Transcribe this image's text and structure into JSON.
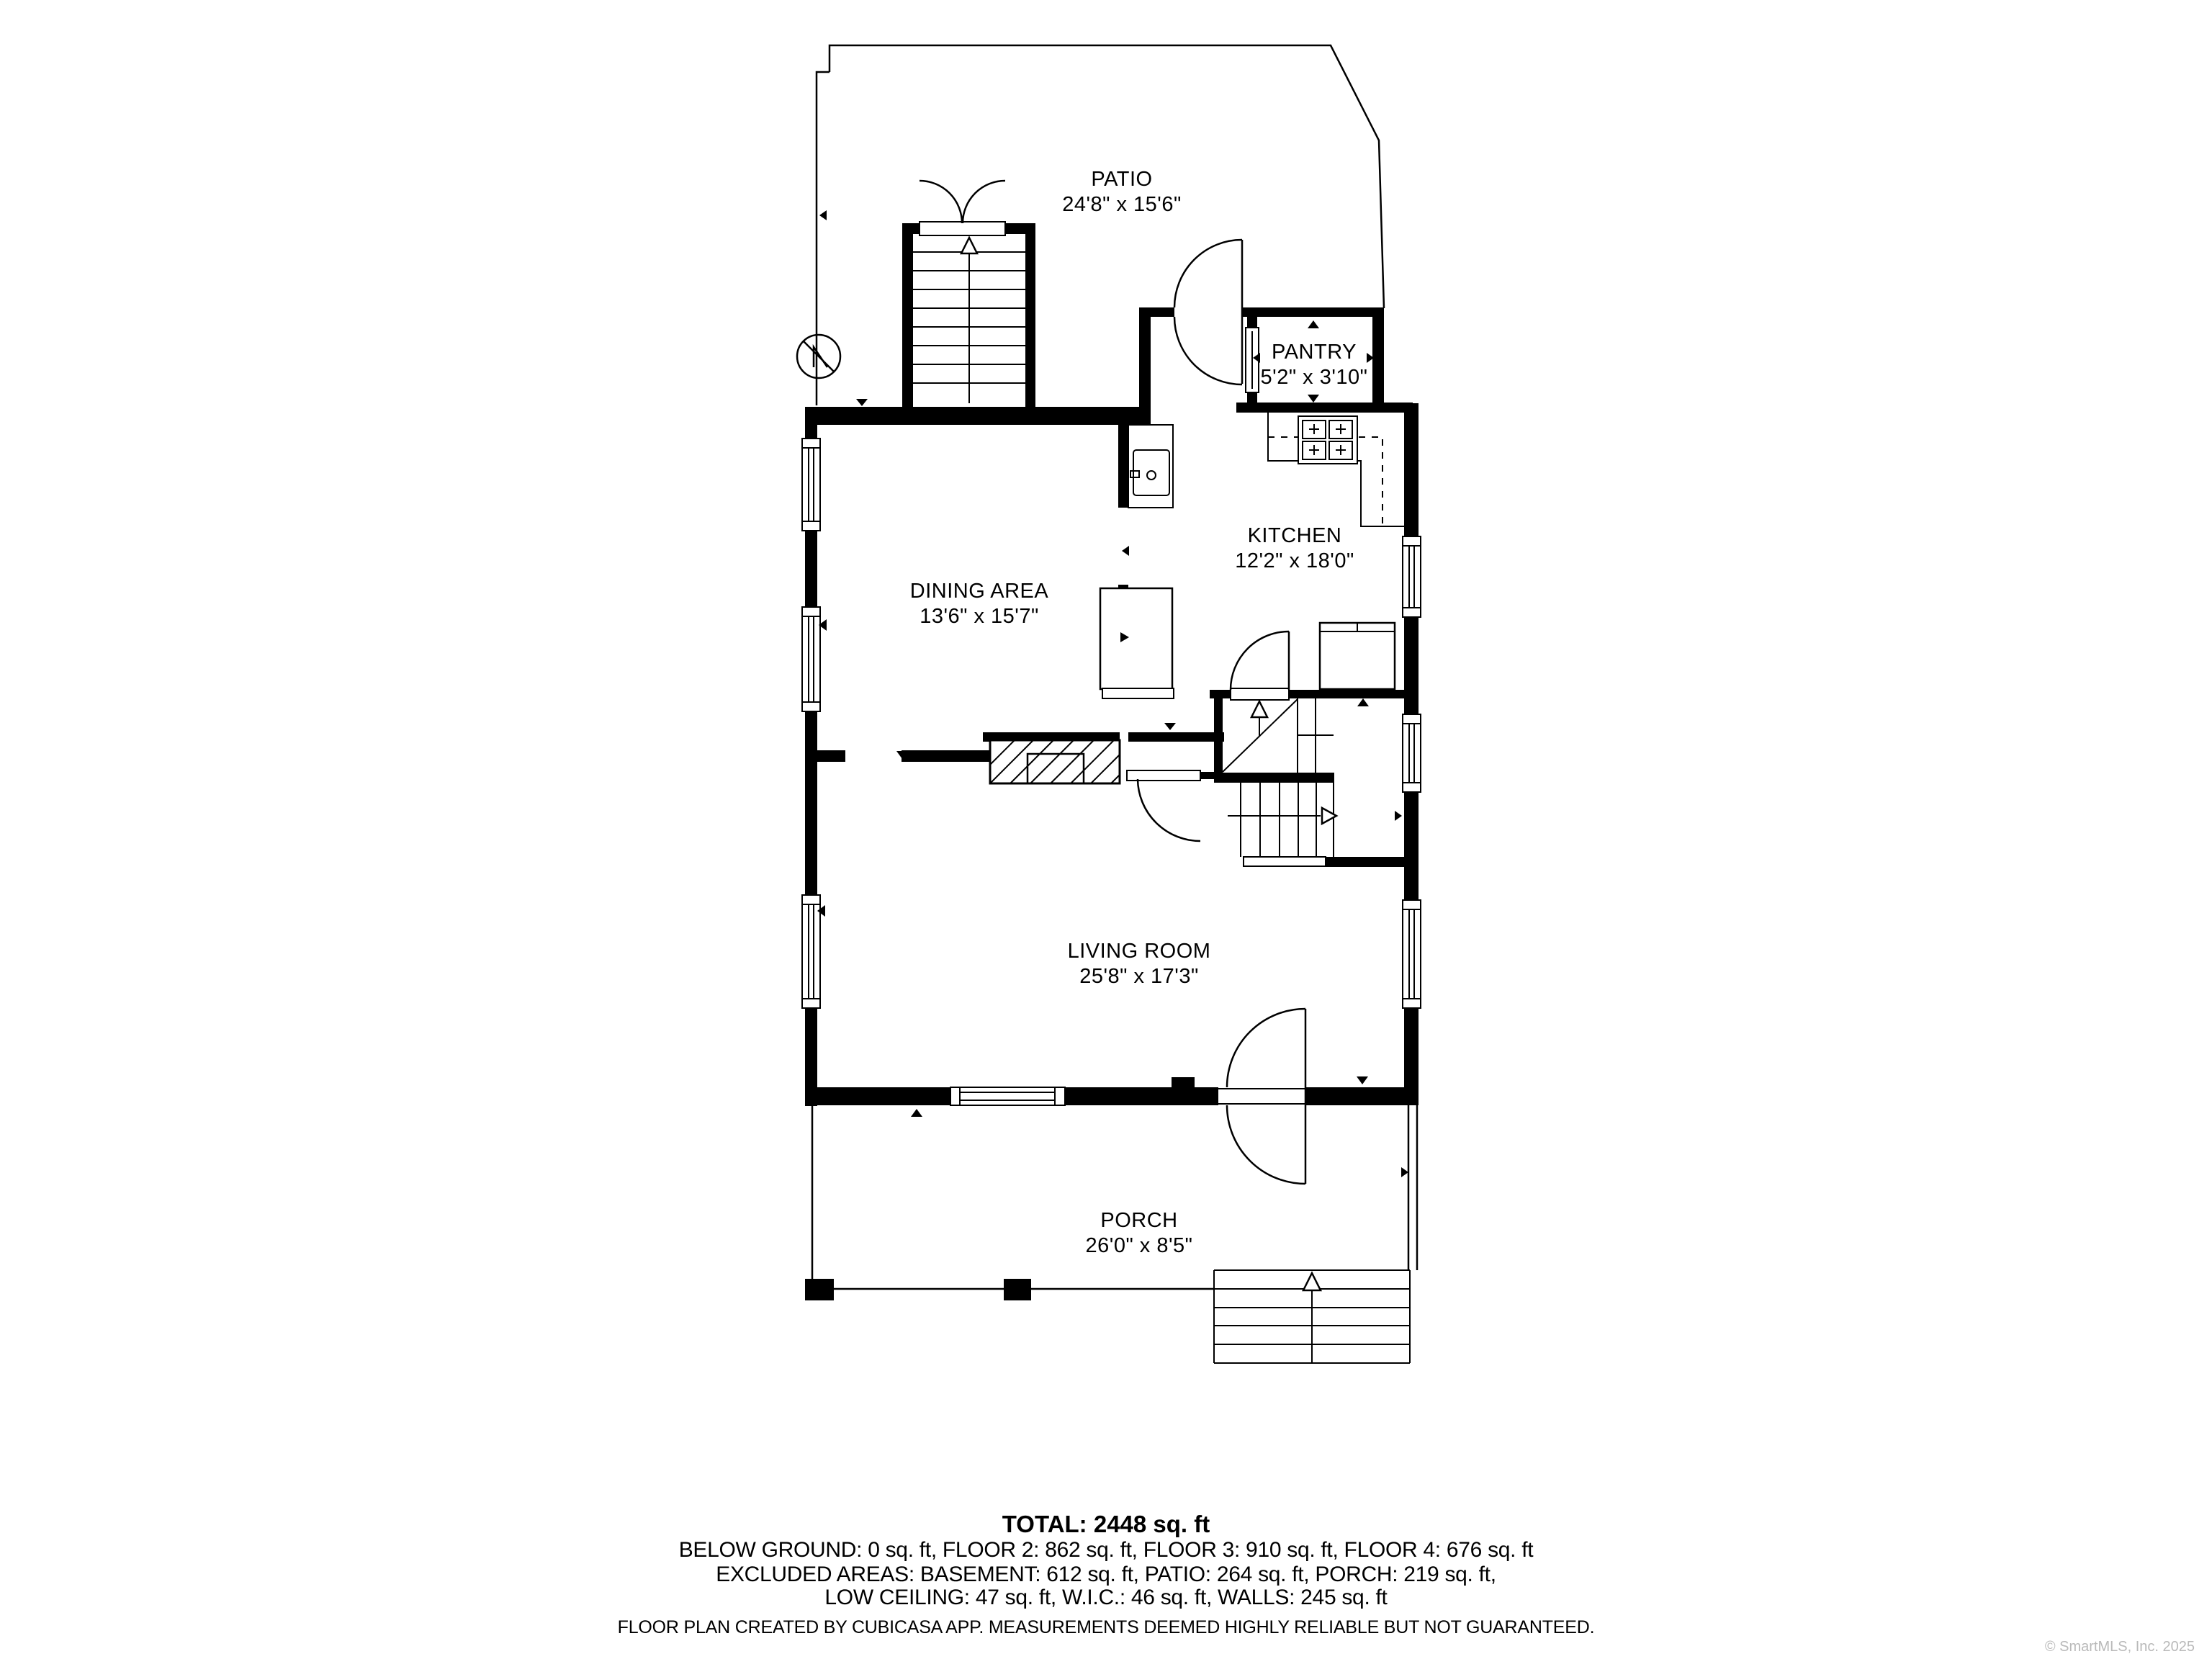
{
  "plan": {
    "type": "floor-plan",
    "rooms": [
      {
        "id": "patio",
        "name": "PATIO",
        "dims": "24'8\" x 15'6\""
      },
      {
        "id": "pantry",
        "name": "PANTRY",
        "dims": "5'2\" x 3'10\""
      },
      {
        "id": "kitchen",
        "name": "KITCHEN",
        "dims": "12'2\" x 18'0\""
      },
      {
        "id": "dining-area",
        "name": "DINING AREA",
        "dims": "13'6\" x 15'7\""
      },
      {
        "id": "living-room",
        "name": "LIVING ROOM",
        "dims": "25'8\" x 17'3\""
      },
      {
        "id": "porch",
        "name": "PORCH",
        "dims": "26'0\" x 8'5\""
      }
    ],
    "colors": {
      "wall": "#000000",
      "background": "#ffffff",
      "watermark": "#b9b9b9"
    }
  },
  "summary": {
    "total": "TOTAL: 2448 sq. ft",
    "line1": "BELOW GROUND: 0 sq. ft, FLOOR 2: 862 sq. ft, FLOOR 3: 910 sq. ft, FLOOR 4: 676 sq. ft",
    "line2": "EXCLUDED AREAS: BASEMENT: 612 sq. ft, PATIO: 264 sq. ft, PORCH: 219 sq. ft,",
    "line3": "LOW CEILING: 47 sq. ft, W.I.C.: 46 sq. ft, WALLS: 245 sq. ft"
  },
  "footer": {
    "text": "FLOOR PLAN CREATED BY CUBICASA APP. MEASUREMENTS DEEMED HIGHLY RELIABLE BUT NOT GUARANTEED."
  },
  "watermark": {
    "text": "© SmartMLS, Inc. 2025"
  }
}
